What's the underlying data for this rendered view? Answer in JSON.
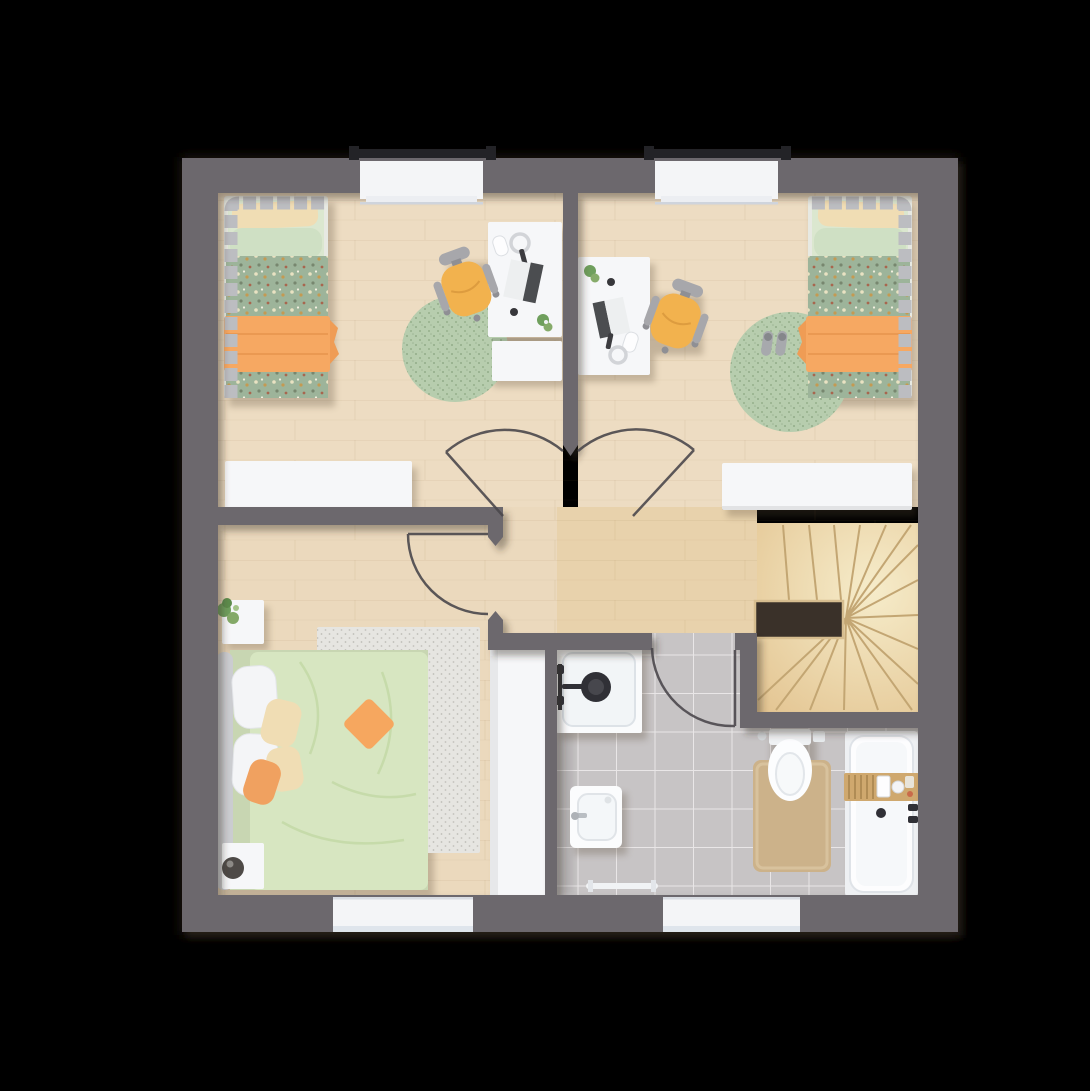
{
  "scene": {
    "type": "apartment-upper-floor-plan-top-view",
    "background": "#000000"
  },
  "palette": {
    "wall": "#6c686d",
    "wall_shadow": "rgba(56,45,36,0.40)",
    "floor_wood": "#eddcc2",
    "floor_hall": "#e8d2ac",
    "floor_master": "#ebd9bd",
    "tile": "#c7c4c5",
    "stairs_light": "#f6ecca",
    "stairs": "#e2c28e",
    "stair_void": "#3a3129",
    "stair_edge": "#d6bd8f",
    "stair_tread": "#c3a673",
    "window_white": "#f4f5f7",
    "window_lintel": "#232327",
    "door_stroke": "#4b484c",
    "rug_green": "#b7cdae",
    "rug_light": "#e6e5e1",
    "bed_frame": "#bcbdc1",
    "sheet_green": "#dbe7cf",
    "pillow_cream": "#f0ddb4",
    "pillow_green": "#cfe0c4",
    "pillow_white": "#f4f5f7",
    "duvet_polka": "#9db49a",
    "blanket_orange": "#f6a862",
    "duvet_master": "#d7e6c1",
    "headboard": "#cbccd0",
    "white_furniture": "#f6f7f9",
    "chair_yellow": "#f2b24e",
    "chair_gray": "#a7a7ab",
    "mat_tan": "#ccb28a",
    "tray_wood": "#cfa86e",
    "plant_green": "#6f9f5d",
    "fixture_dark": "#303036",
    "vase_dark": "#4e4a47"
  },
  "rooms": [
    {
      "name": "children-bedroom-left",
      "furniture": [
        "single-bed",
        "polka-dot-duvet",
        "orange-blanket",
        "desk",
        "drawer-unit",
        "desk-chair",
        "round-rug",
        "dresser",
        "window"
      ]
    },
    {
      "name": "children-bedroom-right",
      "furniture": [
        "single-bed",
        "polka-dot-duvet",
        "orange-blanket",
        "desk",
        "desk-chair",
        "round-rug",
        "slippers",
        "dresser",
        "window"
      ]
    },
    {
      "name": "master-bedroom",
      "furniture": [
        "double-bed",
        "headboard",
        "nightstand-with-plant",
        "nightstand-with-vase",
        "area-rug",
        "wardrobe",
        "window"
      ]
    },
    {
      "name": "bathroom",
      "furniture": [
        "shower",
        "washbasin",
        "toilet",
        "bath-mat",
        "bathtub",
        "bath-caddy-tray",
        "towel-rail",
        "window"
      ]
    },
    {
      "name": "hallway-landing",
      "furniture": []
    },
    {
      "name": "staircase",
      "furniture": [
        "winder-stairs",
        "stair-void"
      ]
    }
  ]
}
